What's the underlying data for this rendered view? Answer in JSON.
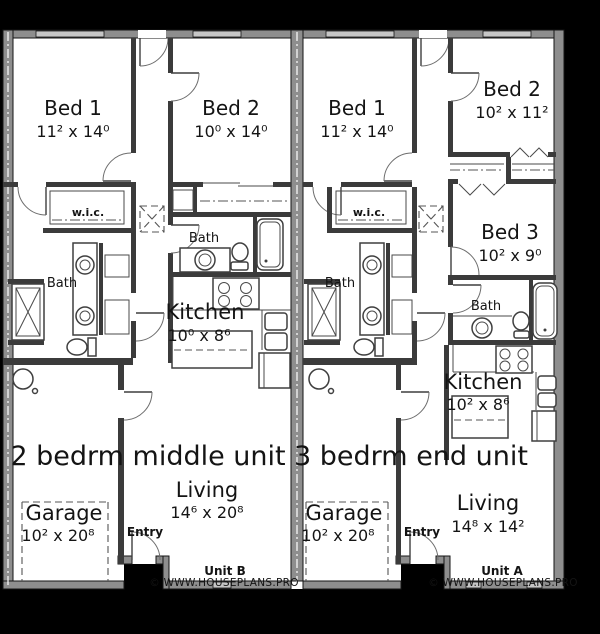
{
  "colors": {
    "background": "#000000",
    "plan_floor": "#ffffff",
    "wall_gray": "#8e8e8e",
    "wall_dark": "#3b3b3b",
    "window_gray": "#c6c6c6",
    "text": "#141414"
  },
  "units": {
    "unit_b": {
      "title": "2 bedrm middle unit",
      "unit_label": "Unit B",
      "copyright": "© WWW.HOUSEPLANS.PRO",
      "rooms": {
        "bed1": {
          "name": "Bed 1",
          "dims": "11² x 14⁰"
        },
        "bed2": {
          "name": "Bed 2",
          "dims": "10⁰ x 14⁰"
        },
        "wic": {
          "name": "w.i.c."
        },
        "bath_master": {
          "name": "Bath"
        },
        "bath_hall": {
          "name": "Bath"
        },
        "kitchen": {
          "name": "Kitchen",
          "dims": "10⁰ x  8⁶"
        },
        "living": {
          "name": "Living",
          "dims": "14⁶ x 20⁸"
        },
        "garage": {
          "name": "Garage",
          "dims": "10² x 20⁸"
        },
        "entry": {
          "name": "Entry"
        }
      }
    },
    "unit_a": {
      "title": "3 bedrm end unit",
      "unit_label": "Unit A",
      "copyright": "© WWW.HOUSEPLANS.PRO",
      "rooms": {
        "bed1": {
          "name": "Bed 1",
          "dims": "11² x 14⁰"
        },
        "bed2": {
          "name": "Bed 2",
          "dims": "10² x 11²"
        },
        "bed3": {
          "name": "Bed 3",
          "dims": "10² x  9⁰"
        },
        "wic": {
          "name": "w.i.c."
        },
        "bath_master": {
          "name": "Bath"
        },
        "bath_hall": {
          "name": "Bath"
        },
        "kitchen": {
          "name": "Kitchen",
          "dims": "10² x  8⁶"
        },
        "living": {
          "name": "Living",
          "dims": "14⁸ x 14²"
        },
        "garage": {
          "name": "Garage",
          "dims": "10² x 20⁸"
        },
        "entry": {
          "name": "Entry"
        }
      }
    }
  }
}
